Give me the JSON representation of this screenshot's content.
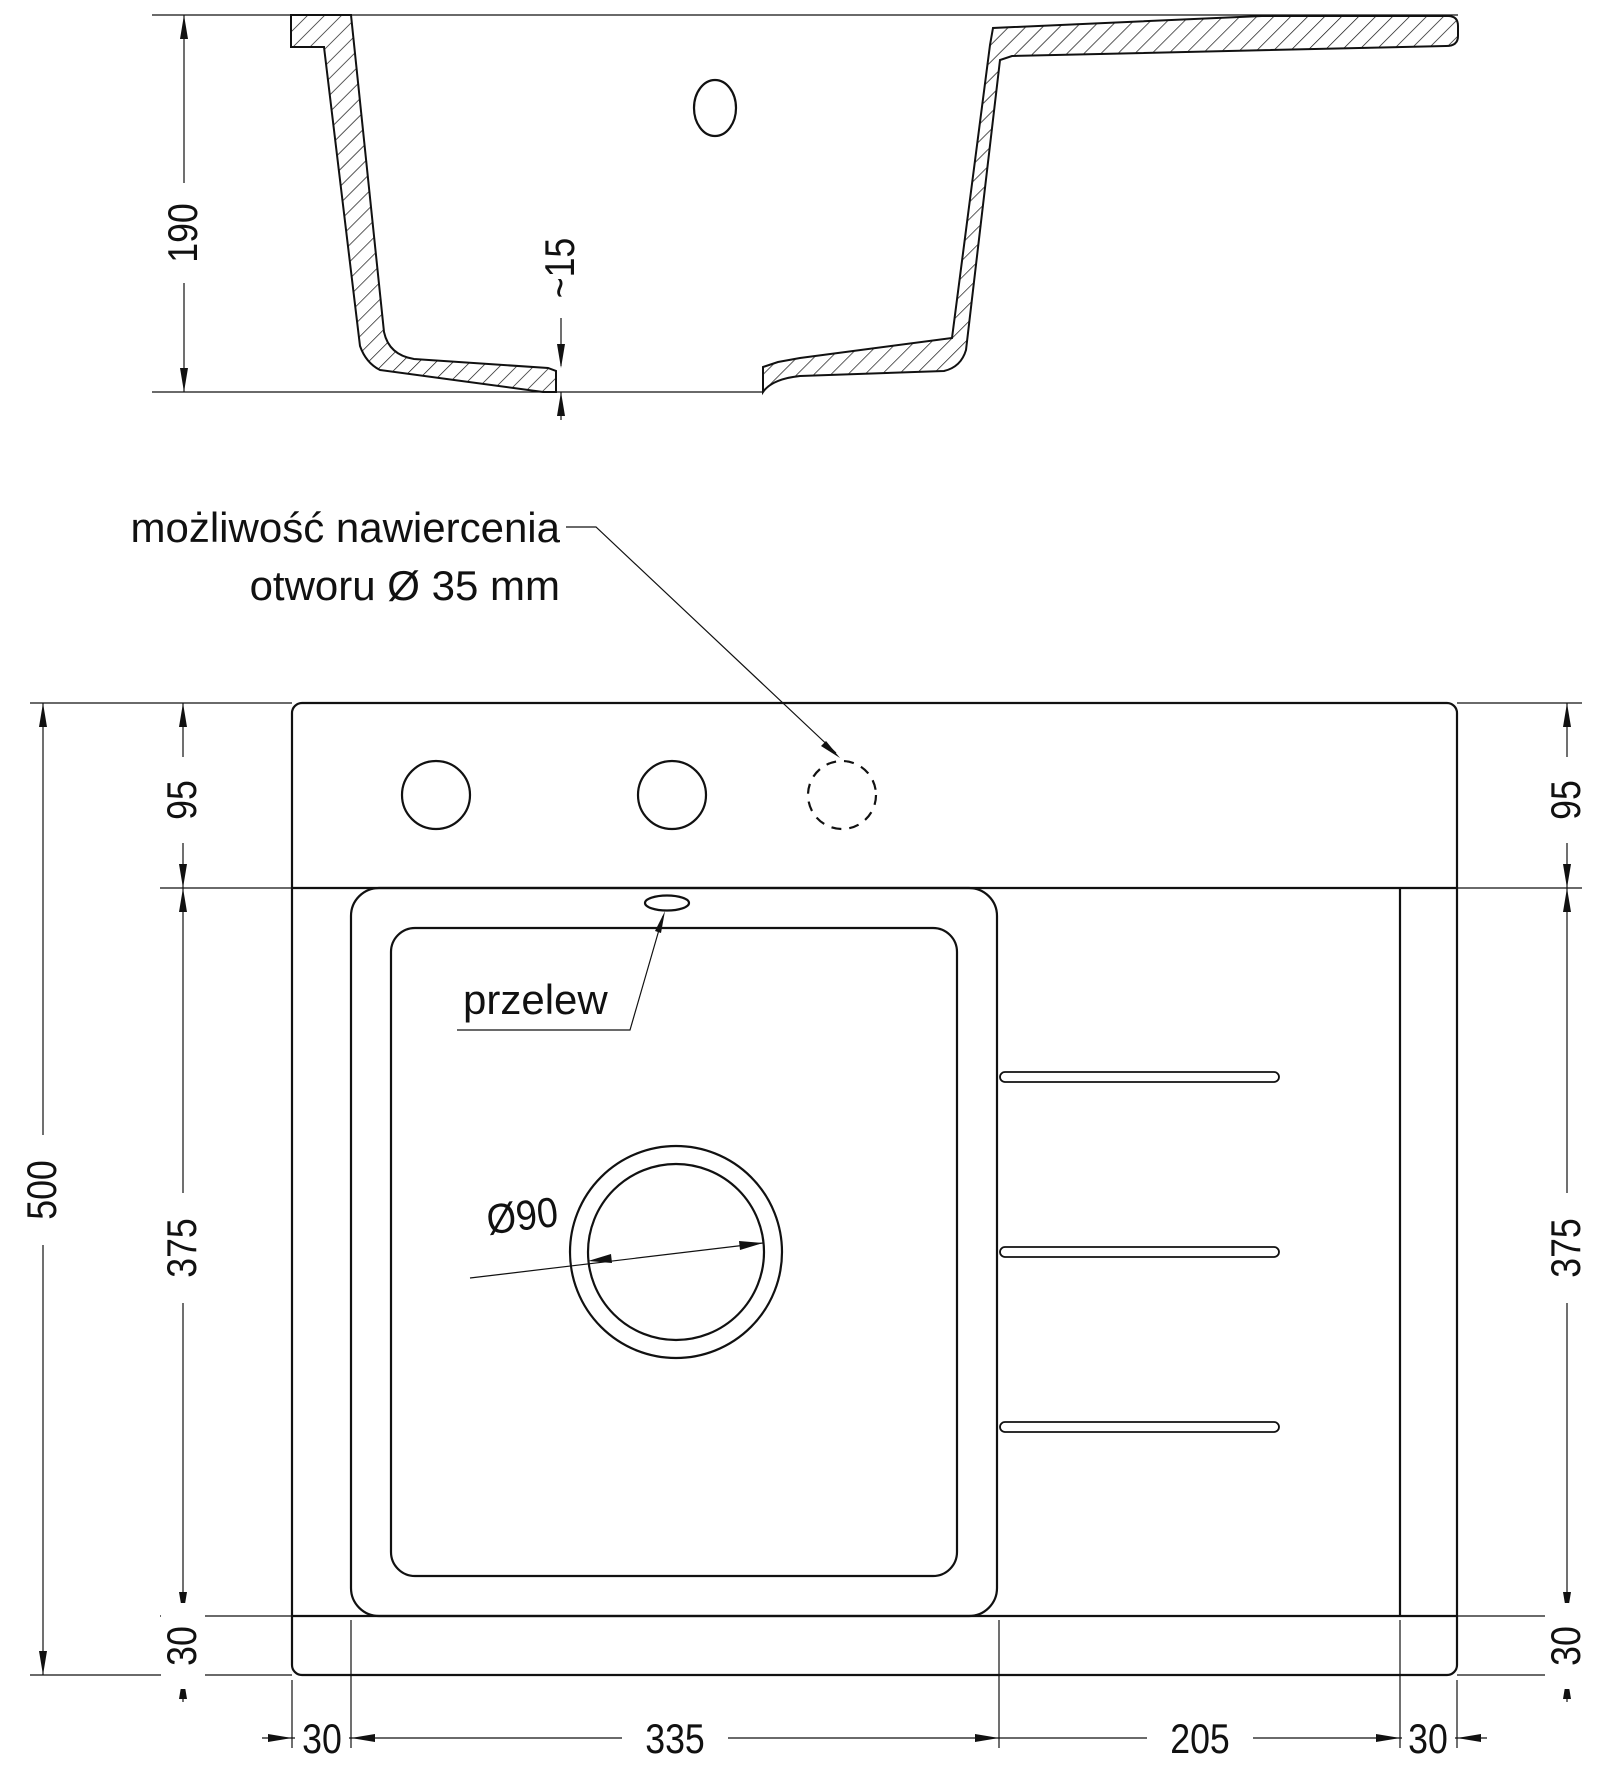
{
  "drawing_type": "sink technical drawing",
  "section_view": {
    "depth_label": "190",
    "floor_thickness_label": "~15"
  },
  "notes": {
    "drill_note_line1": "możliwość nawiercenia",
    "drill_note_line2": "otworu Ø 35 mm",
    "overflow_label": "przelew",
    "drain_diameter_label": "Ø90"
  },
  "top_view_dimensions": {
    "left": {
      "total_height": "500",
      "deck_depth": "95",
      "bowl_depth": "375",
      "front_margin": "30"
    },
    "right": {
      "deck_depth": "95",
      "bowl_depth": "375",
      "front_margin": "30"
    },
    "bottom_chain": {
      "left_margin": "30",
      "bowl_width": "335",
      "drainer_width": "205",
      "right_margin": "30"
    }
  },
  "features": {
    "faucet_holes_solid": 2,
    "faucet_hole_optional_dashed": 1,
    "drainer_ribs": 3,
    "overflow": 1,
    "drain": 1
  },
  "colors": {
    "ink": "#111111",
    "background": "#ffffff"
  }
}
